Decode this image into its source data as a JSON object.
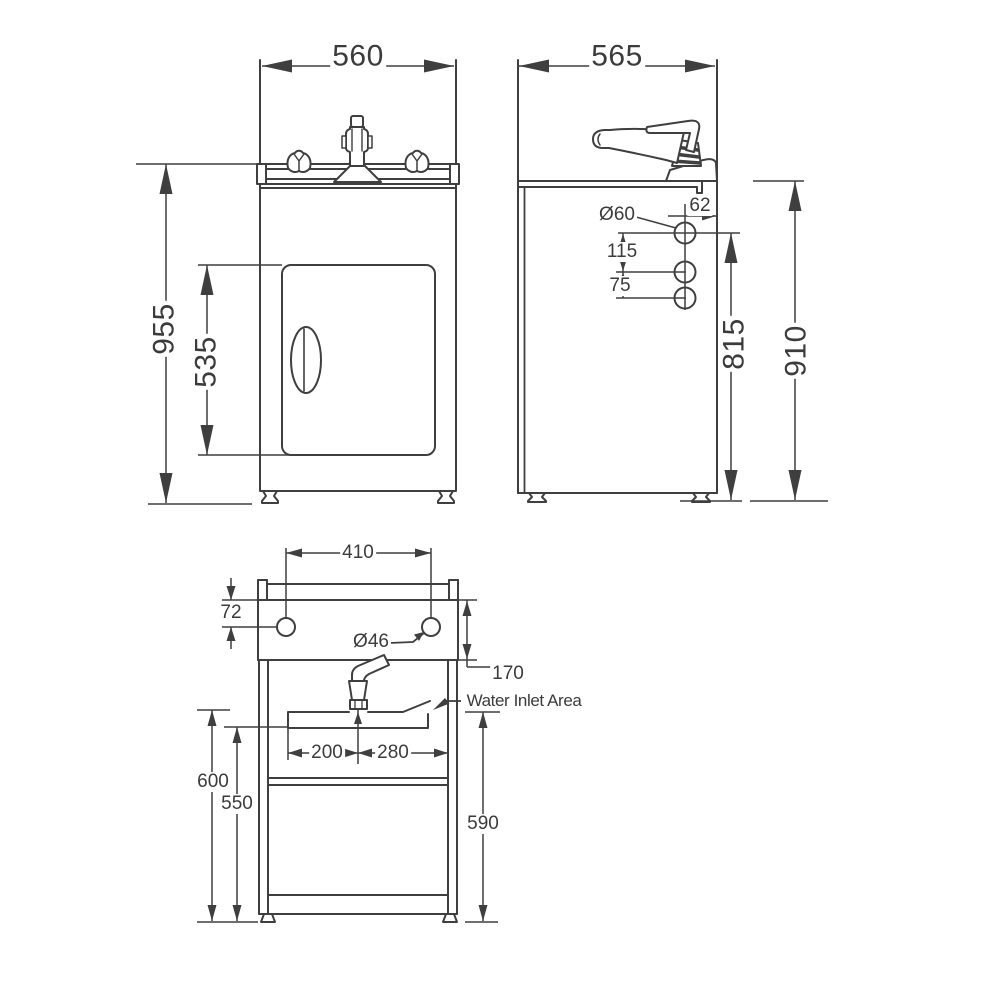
{
  "drawing": {
    "title": "Laundry tub cabinet dimensioned technical drawing, three views",
    "line_color": "#3f3f3f",
    "background": "#ffffff",
    "views": {
      "front": {
        "name": "front elevation",
        "dimensions": [
          "560 overall width",
          "955 overall height",
          "535 door height"
        ]
      },
      "side": {
        "name": "side elevation",
        "dimensions": [
          "565 overall depth",
          "910 bench height",
          "815 inlet hole height",
          "62 hole offset from back",
          "115 hole spacing",
          "75 hole spacing",
          "Ø60 hole diameter"
        ]
      },
      "rear": {
        "name": "rear elevation",
        "dimensions": [
          "410 tap hole centres",
          "72 tap hole drop",
          "Ø46 tap hole diameter",
          "170 splashback height",
          "200 inlet offset",
          "280 inlet offset",
          "600 height",
          "550 height",
          "590 height"
        ],
        "callout": "Water Inlet Area"
      }
    },
    "labels": {
      "front_width": "560",
      "side_depth": "565",
      "front_height": "955",
      "door_height": "535",
      "hole_offset_back": "62",
      "hole_dia_side": "Ø60",
      "hole_spacing_115": "115",
      "hole_spacing_75": "75",
      "inlet_height": "815",
      "bench_height": "910",
      "tap_hole_centres": "410",
      "tap_hole_drop": "72",
      "tap_hole_dia": "Ø46",
      "splashback_height": "170",
      "water_inlet_area": "Water Inlet Area",
      "inlet_offset_left": "200",
      "inlet_offset_right": "280",
      "height_600": "600",
      "height_550": "550",
      "height_590": "590"
    }
  }
}
